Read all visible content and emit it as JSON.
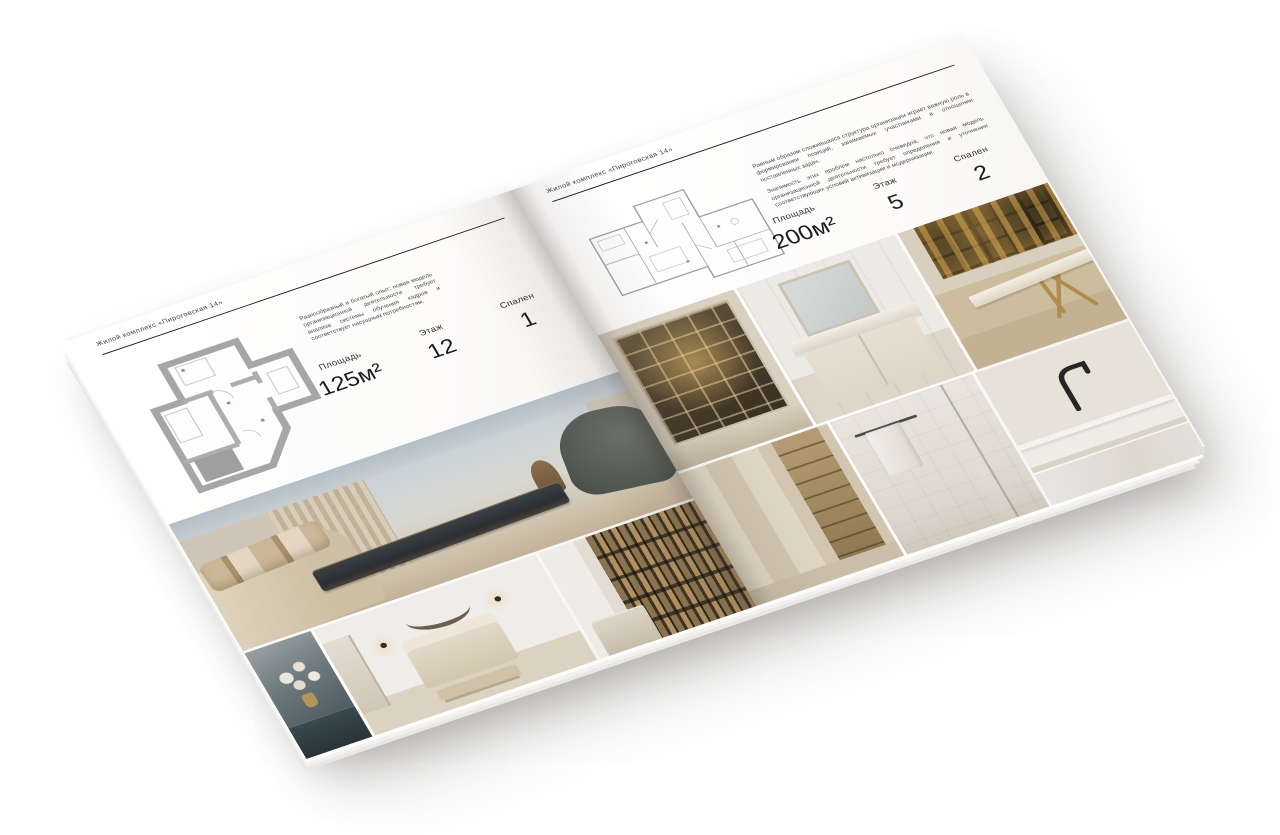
{
  "magazine": {
    "left_page": {
      "header": "Жилой комплекс «Пироговская 14»",
      "paragraphs": [
        "Разнообразный и богатый опыт: новая модель организационной деятельности требует анализа системы обучения кадров и соответствует насущным потребностям."
      ],
      "specs": [
        {
          "label": "Площадь",
          "value": "125м²"
        },
        {
          "label": "Этаж",
          "value": "12"
        },
        {
          "label": "Спален",
          "value": "1"
        }
      ],
      "floor_plan": "floor-plan-125m2",
      "photos": [
        "master-bedroom-panorama",
        "nightstand-flowers",
        "kids-bedroom",
        "hallway-shelves"
      ]
    },
    "right_page": {
      "header": "Жилой комплекс «Пироговская 14»",
      "paragraphs": [
        "Равным образом сложившаяся структура организации играет важную роль в формировании позиций, занимаемых участниками в отношении поставленных задач.",
        "Значимость этих проблем настолько очевидна, что новая модель организационной деятельности требует определения и уточнения соответствующих условий активизации и модернизации."
      ],
      "specs": [
        {
          "label": "Площадь",
          "value": "200м²"
        },
        {
          "label": "Этаж",
          "value": "5"
        },
        {
          "label": "Спален",
          "value": "2"
        }
      ],
      "floor_plan": "floor-plan-200m2",
      "photos": [
        "bar-cabinet",
        "bathroom-vanity",
        "study-gold-desk",
        "wardrobe-closet",
        "shower-towel",
        "kitchen-faucet"
      ]
    },
    "colors": {
      "paper": "#ffffff",
      "text": "#2b2b2b",
      "rule": "#1e1e1e",
      "plan_wall": "#a6a6a6",
      "photo_beige": "#cfc4b2",
      "photo_dark": "#34383c",
      "photo_gold": "#b2915c"
    }
  }
}
